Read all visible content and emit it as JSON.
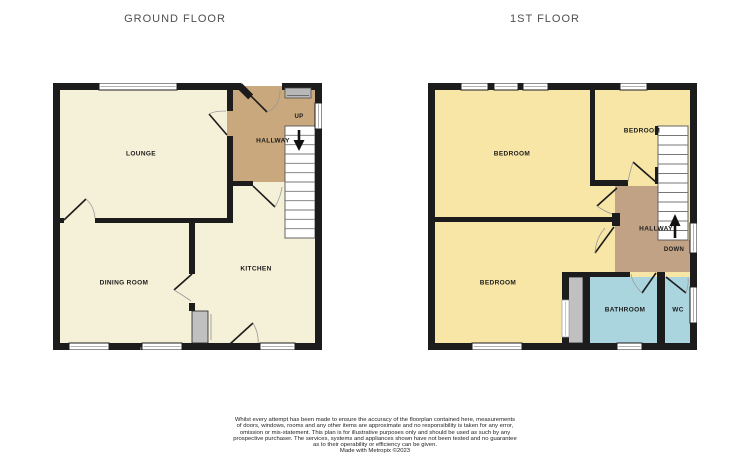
{
  "titles": {
    "ground": "GROUND FLOOR",
    "first": "1ST FLOOR"
  },
  "ground_floor": {
    "lounge": "LOUNGE",
    "hallway": "HALLWAY",
    "kitchen": "KITCHEN",
    "dining_room": "DINING ROOM",
    "stairs_direction": "UP"
  },
  "first_floor": {
    "bedroom_front": "BEDROOM",
    "bedroom_rear_small": "BEDROOM",
    "bedroom_rear": "BEDROOM",
    "hallway": "HALLWAY",
    "bathroom": "BATHROOM",
    "wc": "WC",
    "stairs_direction": "DOWN"
  },
  "colors": {
    "wall": "#1c1c1c",
    "room_cream": "#f5f0d8",
    "room_yellow": "#f8e6a7",
    "hallway_tan": "#c8a87c",
    "hallway_tan_first": "#c2a284",
    "bathroom_blue": "#aad5de",
    "fixture_gray": "#c0c0c0",
    "glazing_gray": "#b8b8b8",
    "title_text": "#4f4f4f",
    "label_text": "#1a1a1a"
  },
  "footer": {
    "lines": [
      "Whilst every attempt has been made to ensure the accuracy of the floorplan contained here, measurements",
      "of doors, windows, rooms and any other items are approximate and no responsibility is taken for any error,",
      "omission or mis-statement. This plan is for illustrative purposes only and should be used as such by any",
      "prospective purchaser. The services, systems and appliances shown have not been tested and no guarantee",
      "as to their operability or efficiency can be given.",
      "Made with Metropix ©2023"
    ]
  }
}
